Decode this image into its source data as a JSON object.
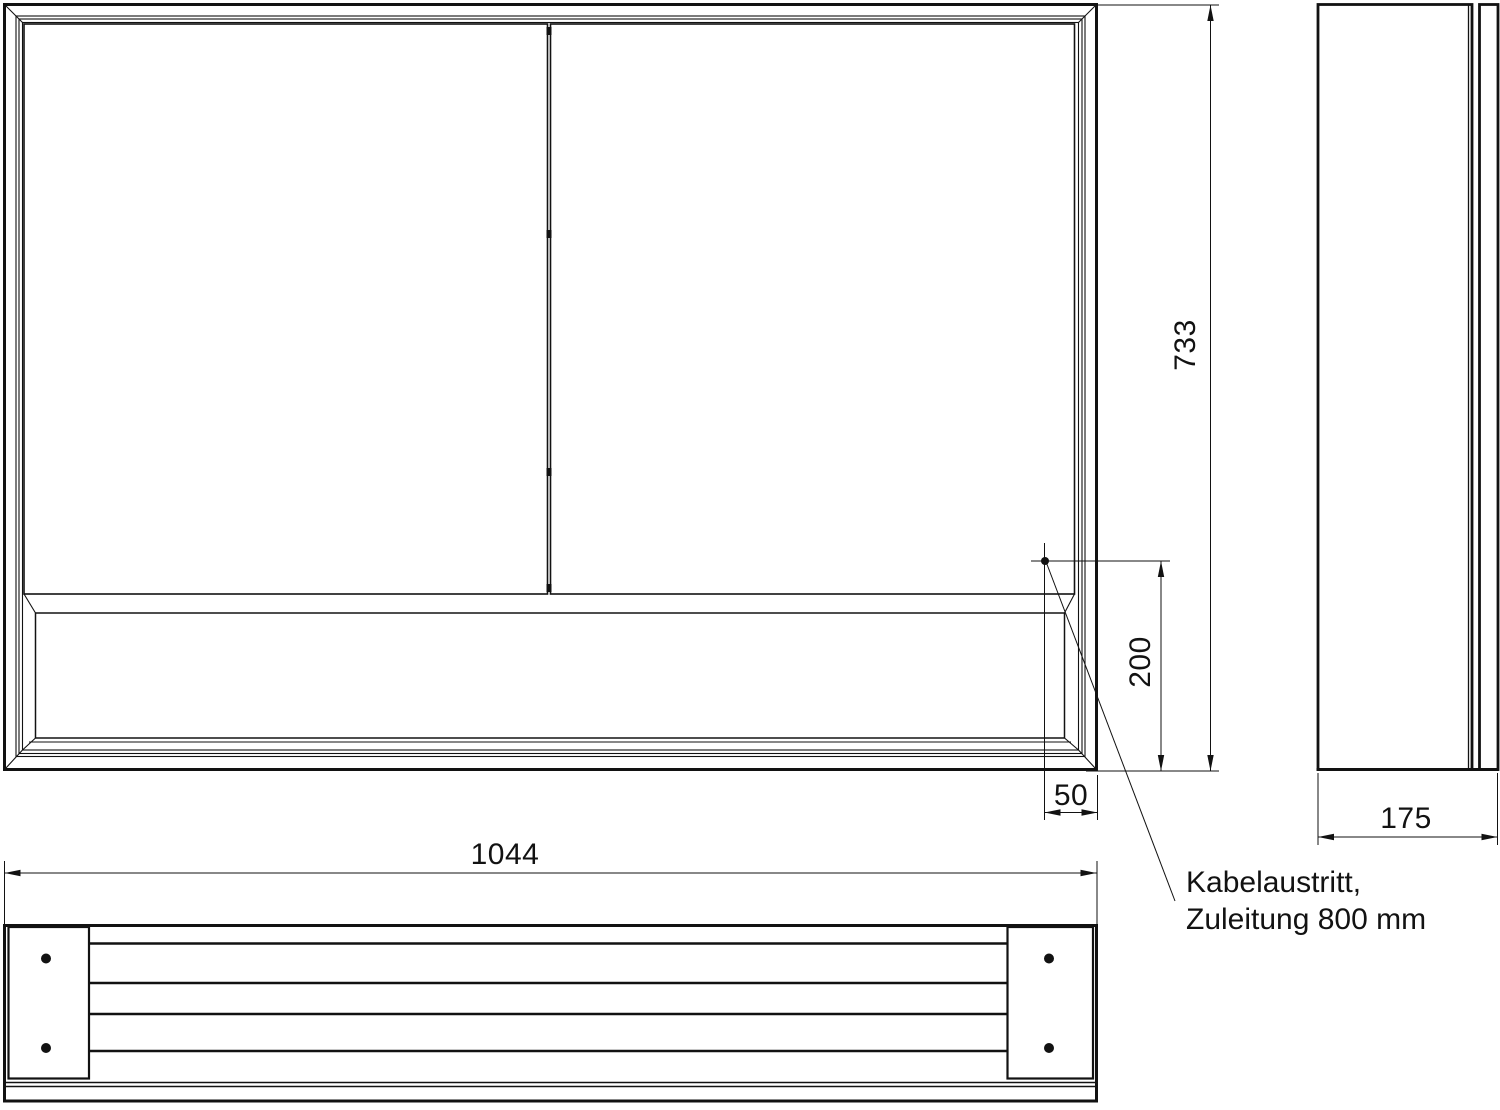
{
  "drawing": {
    "background_color": "#ffffff",
    "line_color": "#121212",
    "views": {
      "front": "front-view",
      "side": "side-view",
      "bottom": "bottom-view"
    },
    "dimensions": {
      "height": "733",
      "cable_outlet_height": "200",
      "cable_outlet_inset": "50",
      "width": "1044",
      "depth": "175"
    },
    "annotation": {
      "line1": "Kabelaustritt,",
      "line2": "Zuleitung 800 mm"
    }
  }
}
